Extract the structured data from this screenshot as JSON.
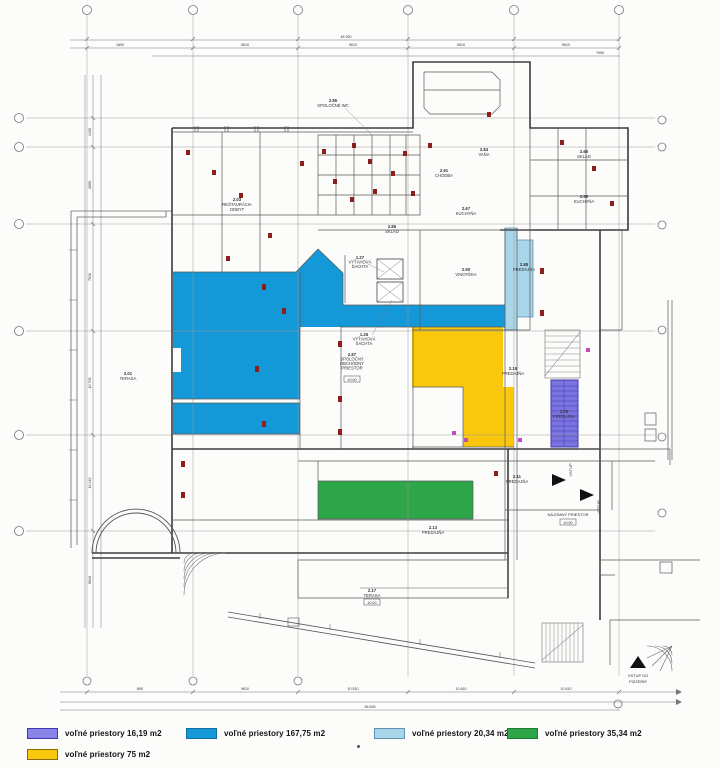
{
  "colors": {
    "blue": "#1598d8",
    "yellow": "#f9c70b",
    "green": "#2fa54a",
    "light_blue": "#a9d6e9",
    "purple": "#7b74e0",
    "purple_dark": "#4038b0",
    "light_blue_border": "#5c93b5",
    "yellow_border": "#c79f00",
    "green_border": "#1e7a35",
    "blue_border": "#0f6fa0",
    "wall": "#3c3c3c",
    "thin": "#8a8a8a",
    "grid": "#9a9a9a",
    "red_mark": "#8e1d1d",
    "magenta_mark": "#c04ac0"
  },
  "legend_items": [
    {
      "label": "voľné priestory 16,19 m2",
      "swatch_color": "#8a83e8",
      "border": "#4038b0"
    },
    {
      "label": "voľné priestory 167,75 m2",
      "swatch_color": "#1598d8",
      "border": "#0f6fa0"
    },
    {
      "label": "voľné priestory 20,34 m2",
      "swatch_color": "#a9d6e9",
      "border": "#5c93b5"
    },
    {
      "label": "voľné priestory 35,34 m2",
      "swatch_color": "#2fa54a",
      "border": "#1e7a35"
    },
    {
      "label": "voľné priestory 75 m2",
      "swatch_color": "#f9c70b",
      "border": "#8a6d00"
    }
  ],
  "rooms": [
    {
      "num": "2.01",
      "name": "TERASA"
    },
    {
      "num": "2.03",
      "name": "REŠTAURÁCIA",
      "name2": "ODBYT"
    },
    {
      "num": "2.85",
      "name": "SPOLOČNÉ WC"
    },
    {
      "num": "2.86",
      "name": "SKLAD"
    },
    {
      "num": "2.84",
      "name": "VAŇA"
    },
    {
      "num": "2.91",
      "name": "CHODBA"
    },
    {
      "num": "2.67",
      "name": "KUCHYŇA"
    },
    {
      "num": "2.66",
      "name": "SKLAD"
    },
    {
      "num": "2.69",
      "name": "KUCHYŇA"
    },
    {
      "num": "2.90",
      "name": "VINOTÉKA"
    },
    {
      "num": "2.88",
      "name": "PREDAJŇA"
    },
    {
      "num": "1.27",
      "name": "VÝŤAHOVÁ",
      "name2": "ŠACHTA"
    },
    {
      "num": "1.26",
      "name": "VÝŤAHOVÁ",
      "name2": "ŠACHTA"
    },
    {
      "num": "2.87",
      "name": "SPOLOČNÝ",
      "name2": "OBCHODNÝ",
      "name3": "PRIESTOR"
    },
    {
      "num": "2.19",
      "name": "PREDAJŇA"
    },
    {
      "num": "2.76",
      "name": "PREDAJŇA"
    },
    {
      "num": "2.13",
      "name": "PREDAJŇA"
    },
    {
      "num": "2.11",
      "name": "PREDAJŇA"
    },
    {
      "num": "2.17",
      "name": "TERASA"
    }
  ],
  "annotations": {
    "vstup": "VSTUP",
    "vstup_do": "VSTUP DO",
    "pizzerie": "PIZZERIE",
    "najomny": "NÁJOMNÝ PRIESTOR",
    "level": "±0,00"
  },
  "dims": {
    "top_total": "48 390",
    "top": [
      "1800",
      "9610",
      "9610",
      "9810",
      "9610",
      "7950"
    ],
    "left": [
      "1400",
      "2805",
      "7610",
      "10 705",
      "10 410",
      "9610"
    ],
    "bottom": [
      "890",
      "9610",
      "10 510",
      "10 810",
      "10 610",
      "4205"
    ],
    "bottom_total": "56 635"
  }
}
